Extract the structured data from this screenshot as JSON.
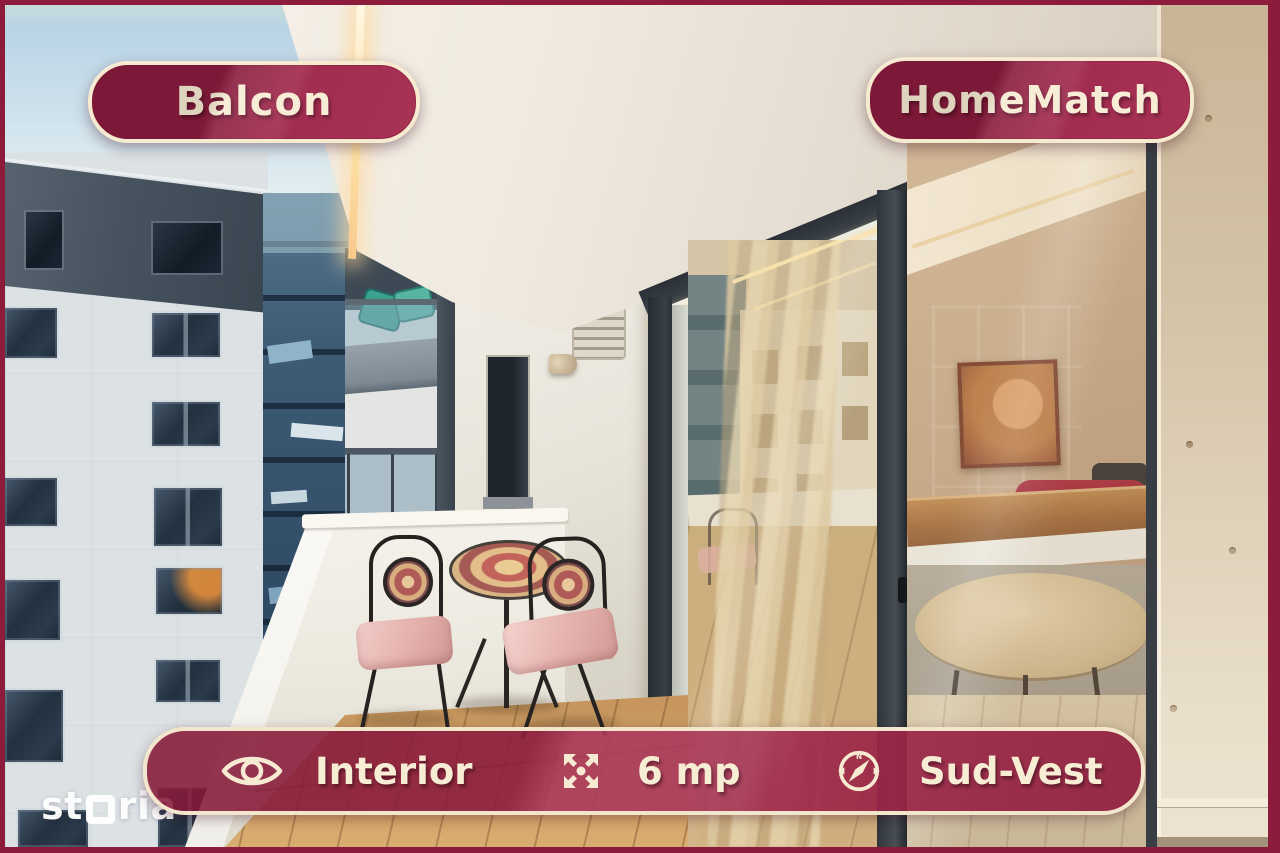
{
  "badges": {
    "left": "Balcon",
    "right": "HomeMatch"
  },
  "info_bar": {
    "interior": {
      "icon": "eye-icon",
      "label": "Interior"
    },
    "area": {
      "icon": "expand-arrows-icon",
      "label": "6 mp"
    },
    "orientation": {
      "icon": "compass-icon",
      "label": "Sud-Vest",
      "compass_north": "N"
    }
  },
  "watermark": {
    "prefix": "st",
    "suffix": "ria",
    "icon": "square-o-glyph"
  },
  "colors": {
    "badge_background": "#9A2145",
    "badge_border": "#F6EAD0",
    "badge_text": "#F7ECD4",
    "frame_border": "#8C1B3C",
    "watermark": "#FFFFFF"
  }
}
